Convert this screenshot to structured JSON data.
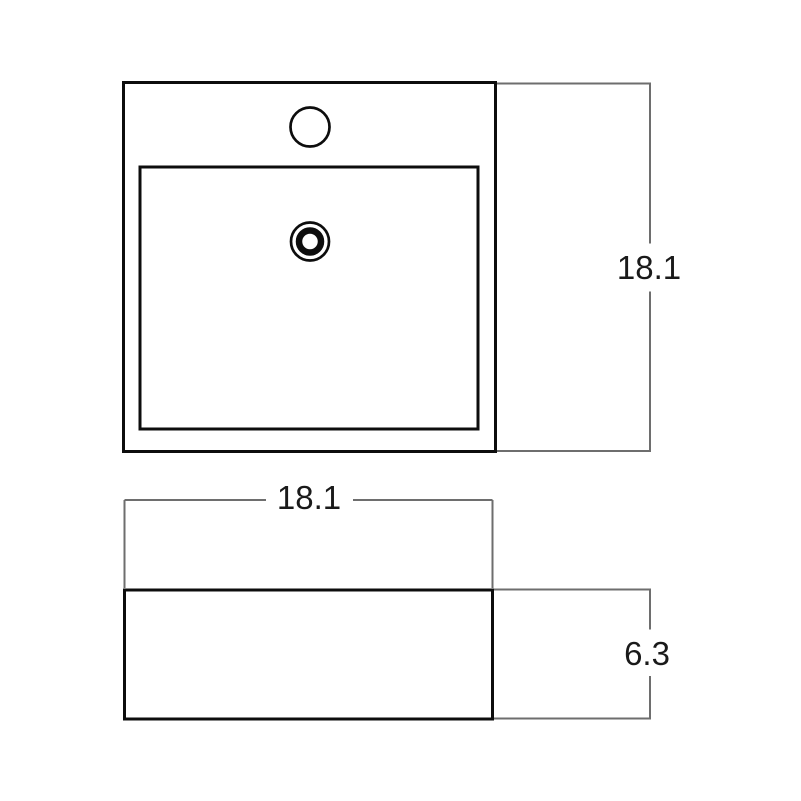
{
  "colors": {
    "background": "#ffffff",
    "outline": "#0d0d0d",
    "dimension": "#6e6e6e",
    "text": "#1a1a1a"
  },
  "views": {
    "top": {
      "depth_dim": "18.1"
    },
    "front": {
      "width_dim": "18.1",
      "height_dim": "6.3"
    }
  }
}
